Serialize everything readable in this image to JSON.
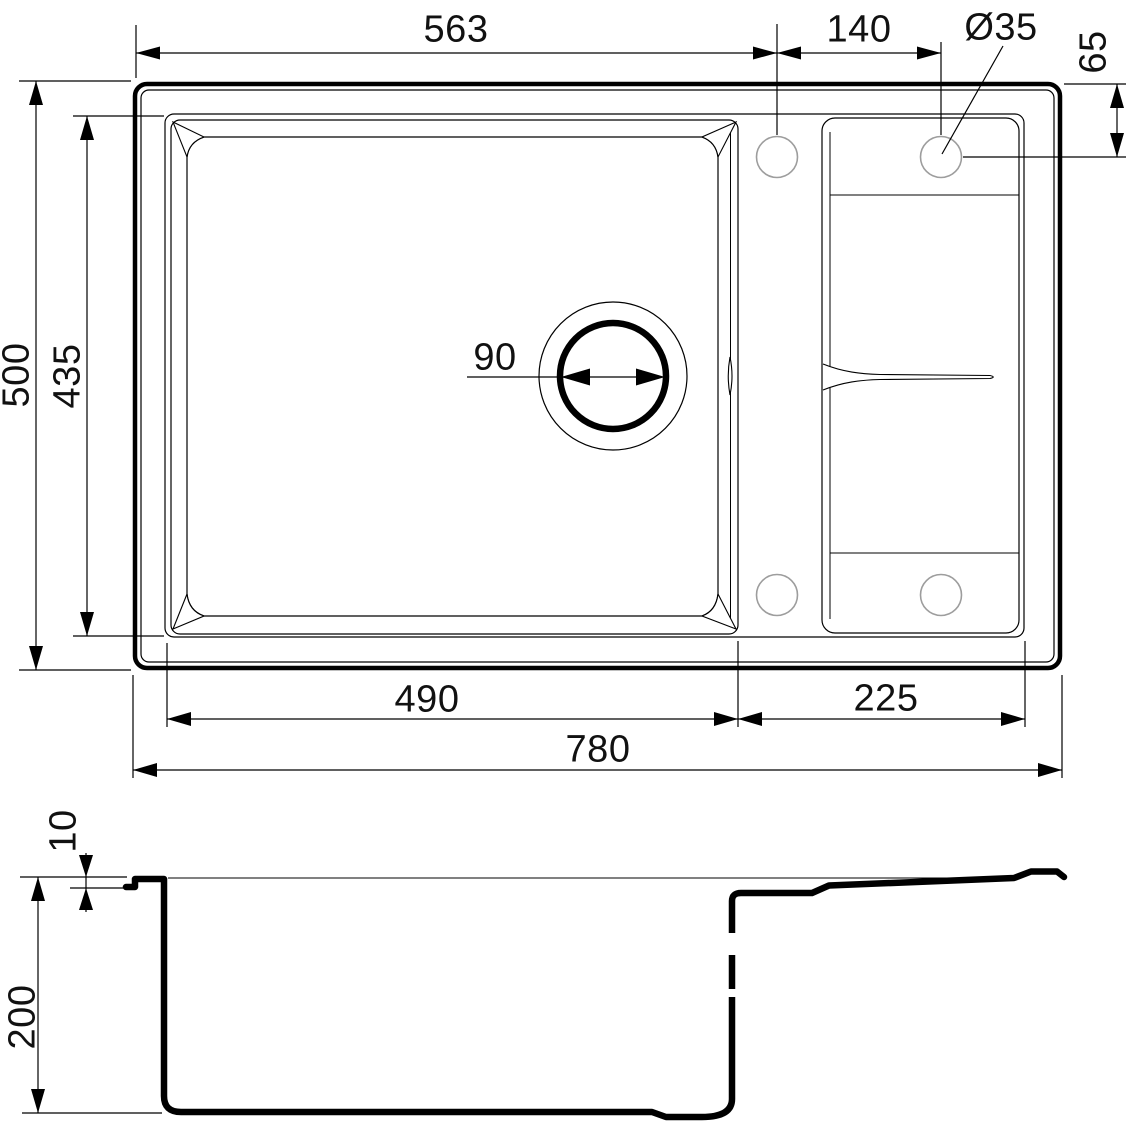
{
  "drawing": {
    "colors": {
      "line": "#000000",
      "tap_hole": "#9d9d9d",
      "background": "#ffffff"
    },
    "top_view": {
      "rim_to_tap_center": "563",
      "tap_hole_spacing": "140",
      "tap_hole_diameter": "Ø35",
      "tap_center_from_edge": "65",
      "overall_depth": "500",
      "basin_inner_depth": "435",
      "drain_diameter": "90",
      "bowl_outer_width": "490",
      "drainboard_width": "225",
      "overall_width": "780"
    },
    "section_view": {
      "rim_height": "10",
      "bowl_depth": "200"
    }
  }
}
